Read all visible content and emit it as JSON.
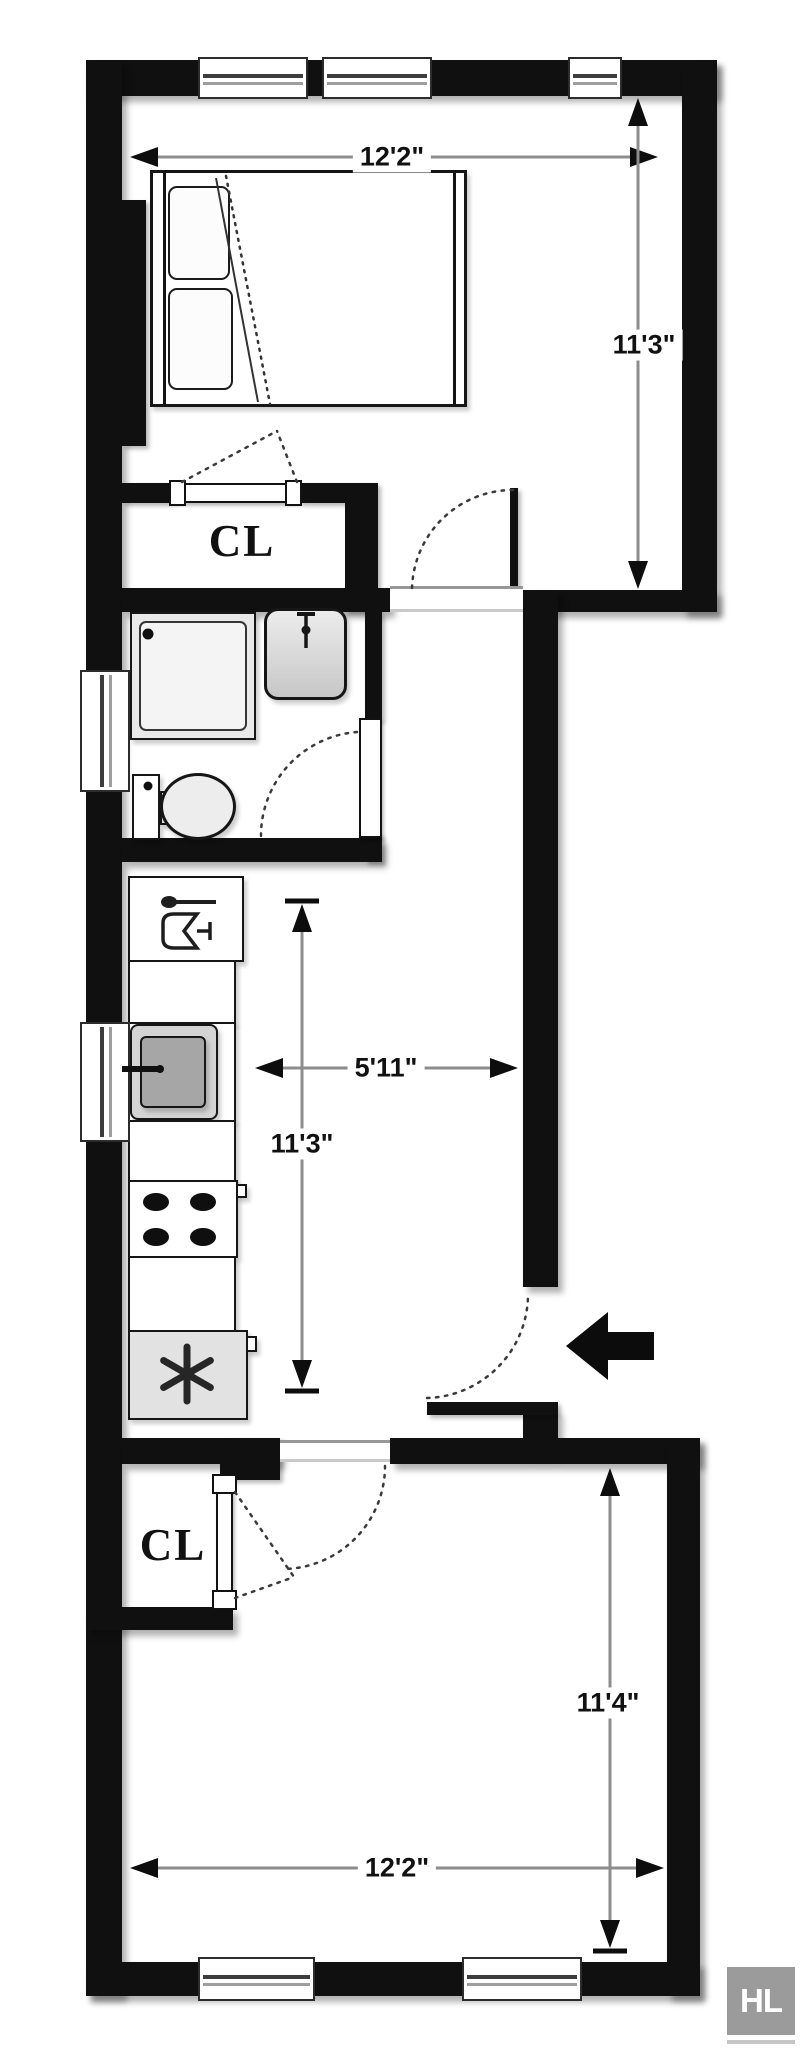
{
  "labels": {
    "closet_upper": "CL",
    "closet_lower": "CL"
  },
  "dimensions": {
    "bedroom_width": "12'2\"",
    "bedroom_depth": "11'3\"",
    "hall_width": "5'11\"",
    "kitchen_depth": "11'3\"",
    "living_depth": "11'4\"",
    "living_width": "12'2\""
  },
  "fixtures": {
    "refrigerator_icon": "asterisk-snowflake-icon",
    "dishwasher_icon": "spoon-and-glass-icon",
    "bath_sink_icon": "faucet-icon",
    "entry_icon": "entry-arrow-icon",
    "stove_icon": "four-burners-icon"
  },
  "logo": {
    "monogram": "HL"
  },
  "colors": {
    "wall": "#101010",
    "dimension_line": "#8d8d8d",
    "dimension_text": "#111111",
    "logo_background": "#9b9b9b",
    "logo_text": "#ffffff",
    "paper": "#ffffff"
  }
}
